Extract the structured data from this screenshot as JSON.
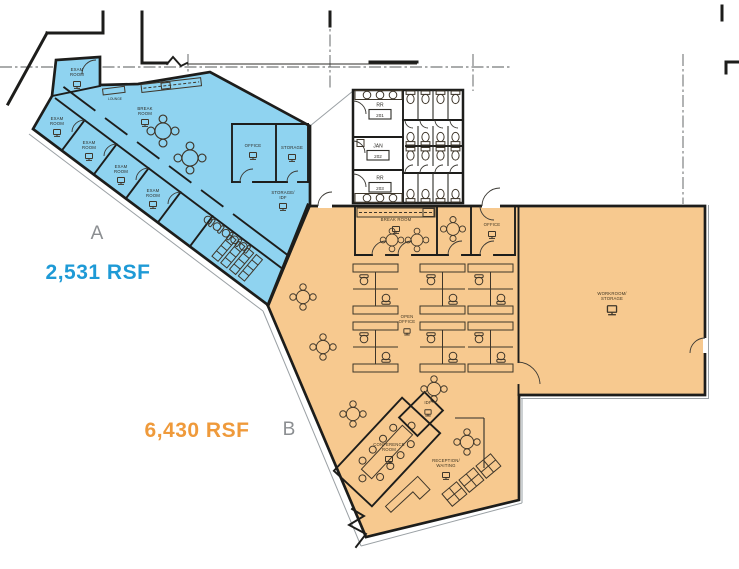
{
  "plan": {
    "suite_a": {
      "letter": "A",
      "rsf": "2,531 RSF",
      "fill_color": "#8FD3F0",
      "accent_color": "#1E9AD6",
      "rooms": {
        "exam_top": [
          "EXAM",
          "ROOM"
        ],
        "exam_2": [
          "EXAM",
          "ROOM"
        ],
        "exam_3": [
          "EXAM",
          "ROOM"
        ],
        "exam_4": [
          "EXAM",
          "ROOM"
        ],
        "exam_5": [
          "EXAM",
          "ROOM"
        ],
        "break_room": [
          "BREAK",
          "ROOM"
        ],
        "lounge": [
          "LOUNGE"
        ],
        "office": [
          "OFFICE"
        ],
        "storage": [
          "STORAGE"
        ],
        "storage_idf": [
          "STORAGE/",
          "IDF"
        ]
      }
    },
    "suite_b": {
      "letter": "B",
      "rsf": "6,430 RSF",
      "fill_color": "#F7C98F",
      "accent_color": "#EF9A3B",
      "rooms": {
        "break_room": [
          "BREAK ROOM"
        ],
        "office": [
          "OFFICE"
        ],
        "open_office": [
          "OPEN",
          "OFFICE"
        ],
        "workroom": [
          "WORKROOM/",
          "STORAGE"
        ],
        "conference": [
          "CONFERENCE",
          "ROOM"
        ],
        "idf": [
          "IDF"
        ],
        "reception": [
          "RECEPTION/",
          "WAITING"
        ]
      }
    },
    "common": {
      "restroom_1": {
        "name": "RR",
        "number": "201"
      },
      "janitor": {
        "name": "JAN",
        "number": "202"
      },
      "restroom_2": {
        "name": "RR",
        "number": "203"
      }
    }
  }
}
